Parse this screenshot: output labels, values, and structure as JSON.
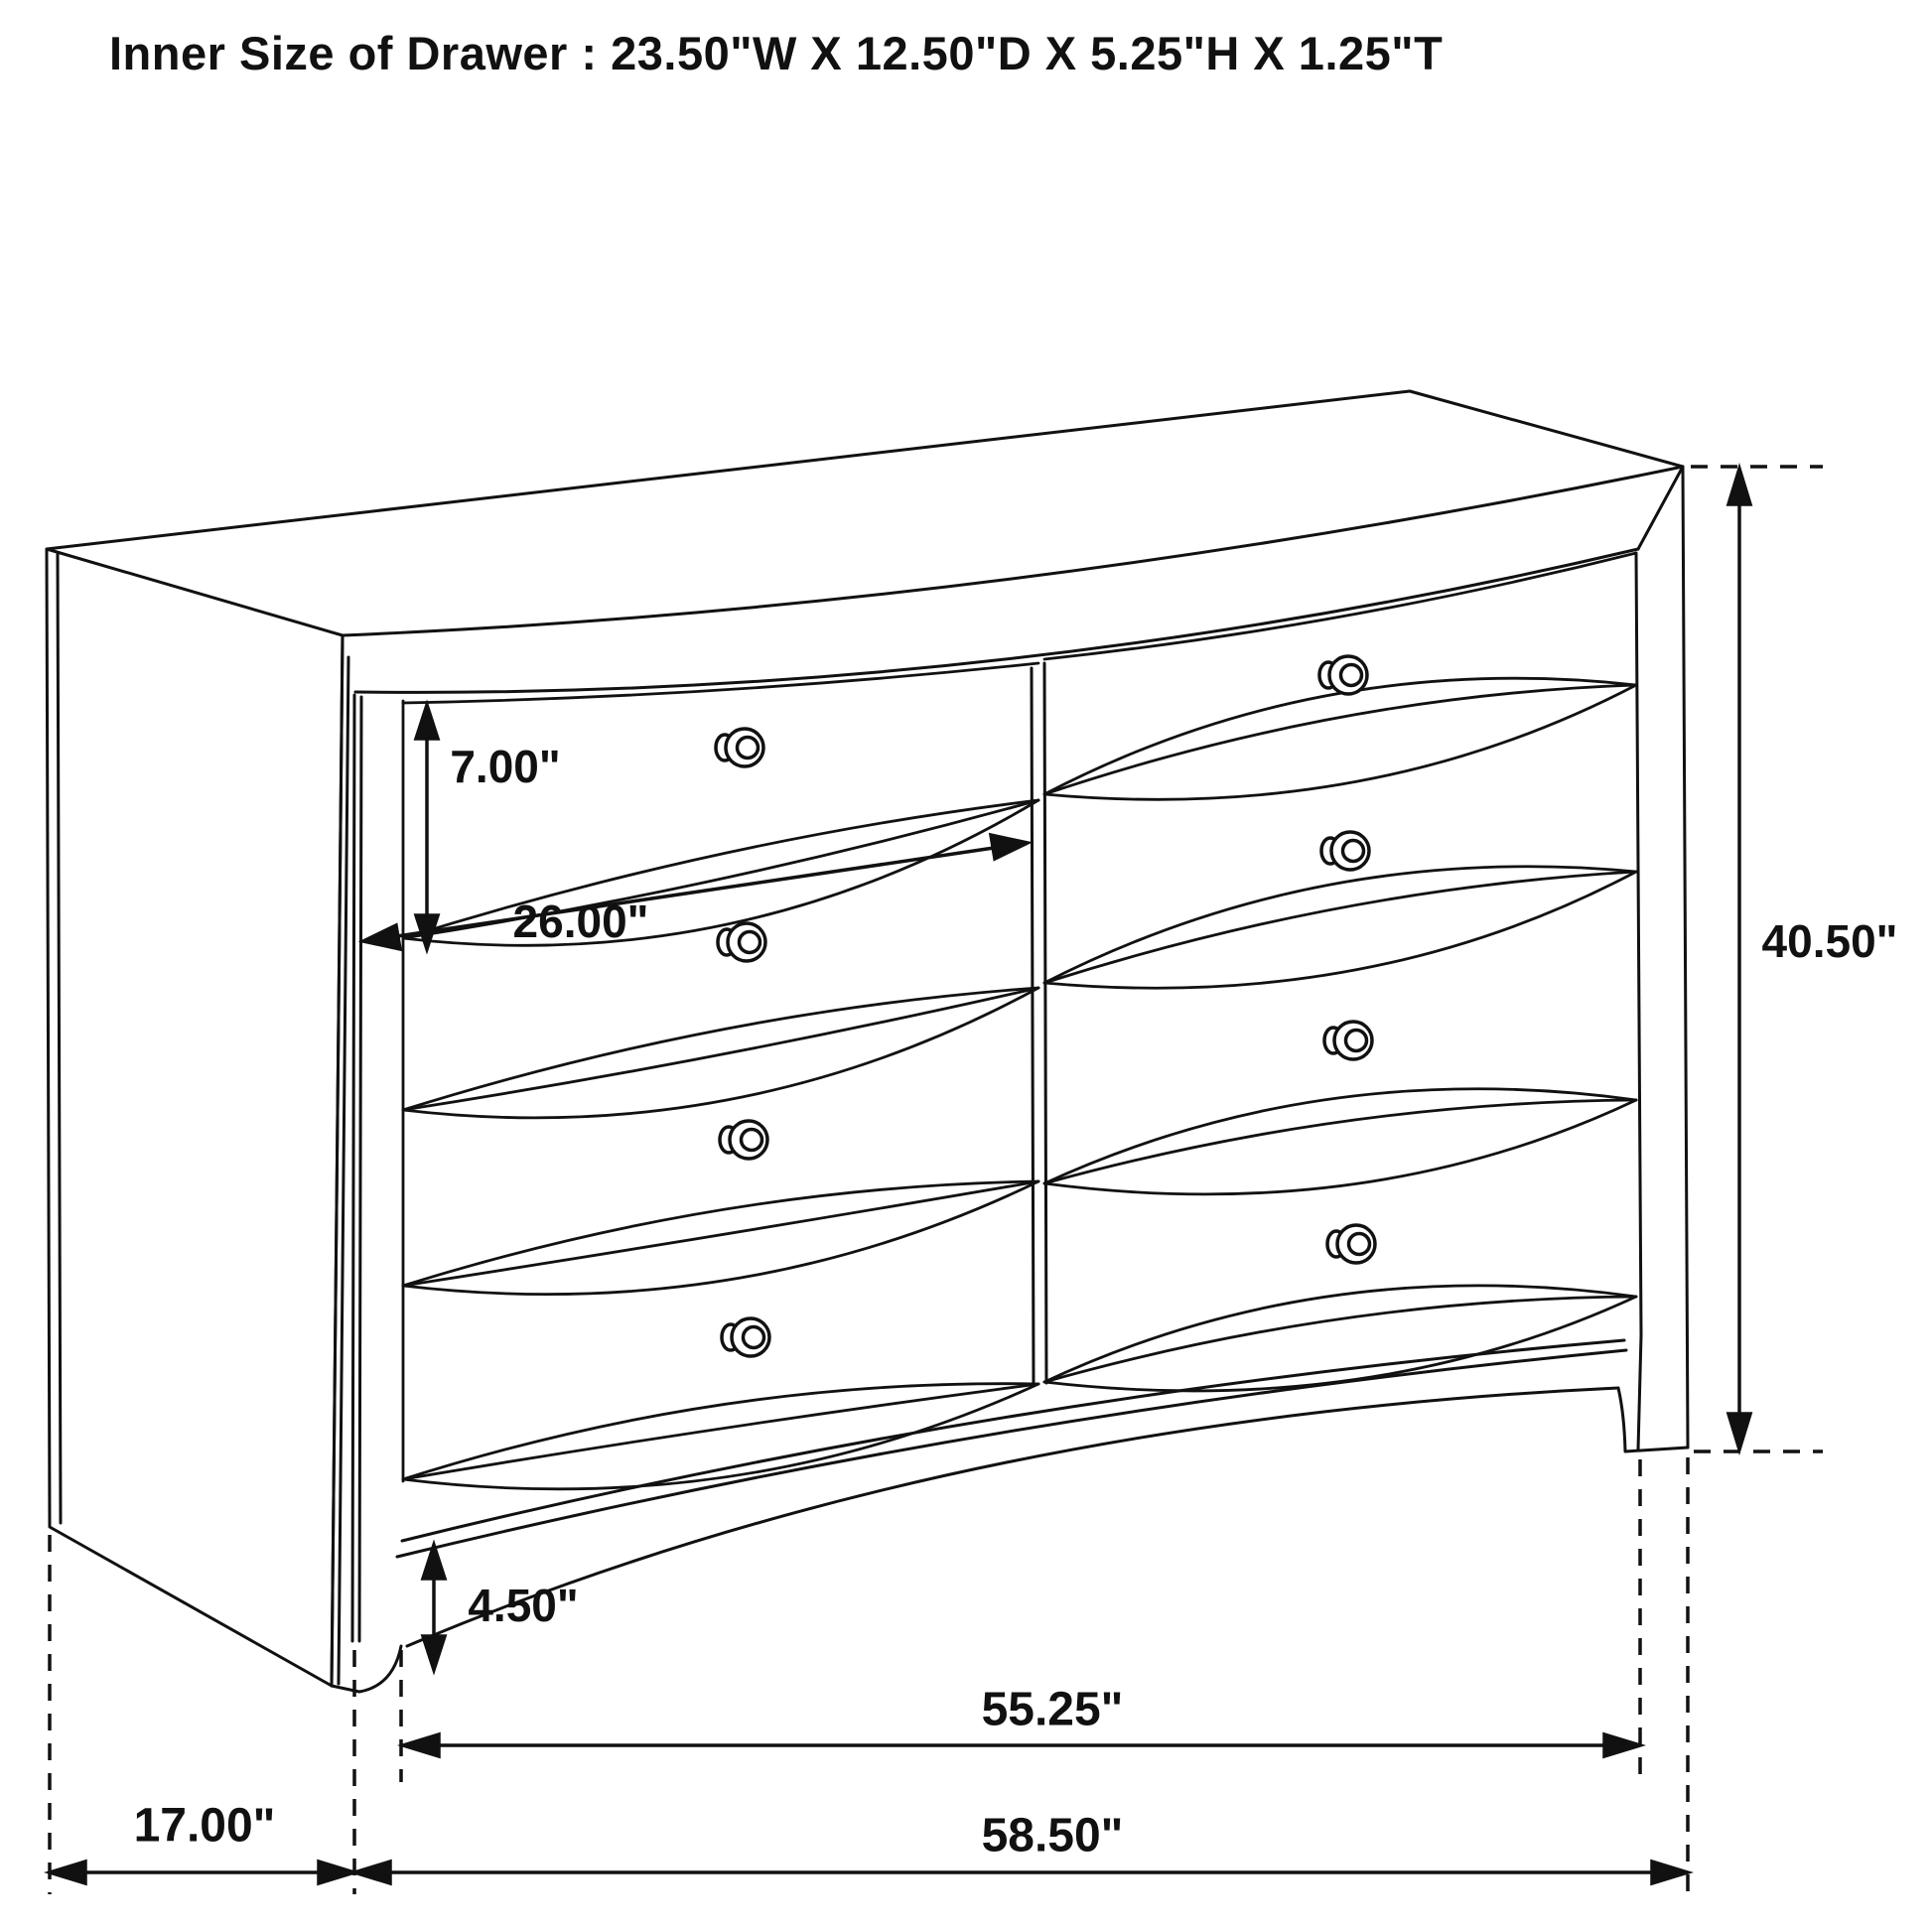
{
  "title": "Inner Size of Drawer : 23.50\"W X 12.50\"D X 5.25\"H X 1.25\"T",
  "diagram": {
    "type": "furniture-dimension-drawing",
    "subject": "six-plus-drawer dresser, two columns of drawers, perspective line art",
    "drawer_columns": 2,
    "drawer_rows": 4,
    "knob_count": 8
  },
  "dimensions": {
    "drawer_opening_height": "7.00\"",
    "drawer_opening_width": "26.00\"",
    "overall_height": "40.50\"",
    "base_height": "4.50\"",
    "front_width": "55.25\"",
    "side_depth": "17.00\"",
    "overall_width": "58.50\""
  },
  "inner_drawer_size": {
    "width": "23.50\"",
    "depth": "12.50\"",
    "height": "5.25\"",
    "thickness": "1.25\""
  },
  "colors": {
    "line": "#111111",
    "background": "#ffffff",
    "text": "#111111"
  }
}
